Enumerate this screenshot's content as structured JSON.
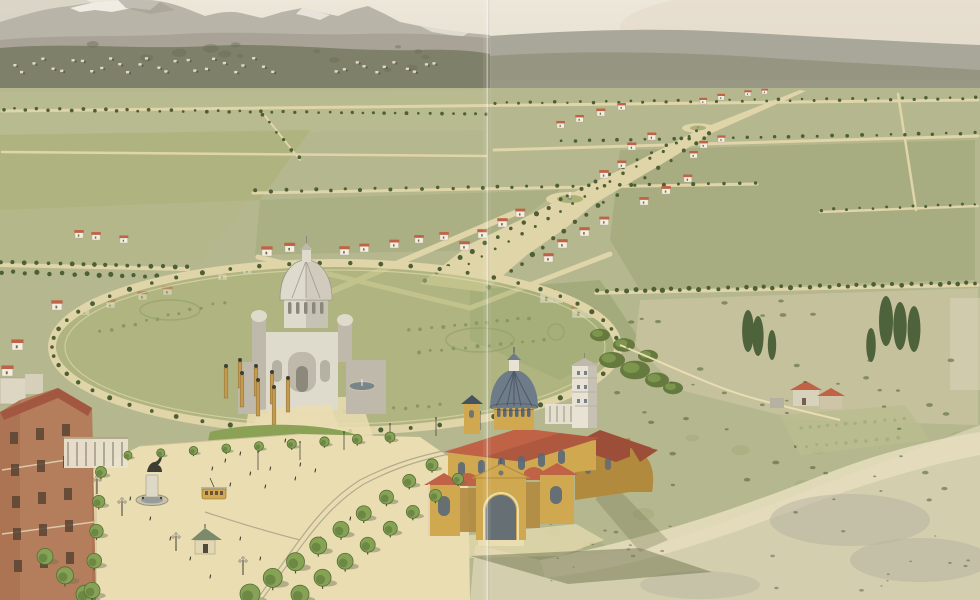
{
  "meta": {
    "description": "Panoramic bird's-eye watercolor view of a planned city extension: tree-lined avenues across an olive plain, a grand diagonal boulevard with roundabouts and scattered red-roofed villas, an elliptical garden plaza holding a white domed votive monument with ochre gateway pylons, an ochre parish church with a slate ribbed dome and white campanile in the foreground, a brick institutional building at lower left, scrubland with a small farmhouse at right, and snow-capped mountains above a distant hillside town."
  },
  "palette": {
    "sky_top": "#ece7d9",
    "sky_bottom": "#ddd7c4",
    "blush": "#e3d4c6",
    "mountain": "#b8b5a8",
    "mountain_shadow": "#a39f91",
    "snow": "#f2efe6",
    "mid_band": "#a6a194",
    "ridge": "#a9a79a",
    "ridge_dark": "#939480",
    "hill_dark": "#7e8069",
    "hill_text": "#6a6d55",
    "town_light": "#ded9c8",
    "town_dark": "#5c5e4c",
    "plain": "#b5b78e",
    "road": "#e0d4a9",
    "road_light": "#ead db2",
    "tree_dark": "#4d5f35",
    "tree_mid": "#66793f",
    "tree_fg": "#86a355",
    "tree_fg_dark": "#546e35",
    "trunk": "#5c4a30",
    "shadow_olive": "#6f7350",
    "garden": "#aab277",
    "bed": "#8fa065",
    "basilica_light": "#dedbcd",
    "basilica_mid": "#beb9aa",
    "basilica_shadow": "#96948a",
    "water": "#6f7d85",
    "pylon": "#c49a4e",
    "church_wall": "#d0a84f",
    "church_wall_dark": "#b28a3e",
    "church_roof": "#bf6246",
    "church_roof_dark": "#9c4e38",
    "dome": "#6e7b88",
    "dome_dark": "#45525f",
    "tower_white": "#e8e2d4",
    "brick": "#ad7454",
    "brick_dark": "#8f5a40",
    "brick_roof": "#a25741",
    "window_dark": "#5a4434",
    "slate": "#5a6878",
    "scrub": "#d3cead",
    "scrub_light": "#e4ddbd",
    "scrub_grey": "#b5b2a1",
    "tram": "#d2a850",
    "dark": "#3e3e34",
    "white": "#f2eee0"
  },
  "scene": {
    "sky": "Pale warm sky",
    "mountains": "Snow-capped mountains",
    "ridge": "Smooth grey-green ridge",
    "hills": "Dark wooded foothills",
    "town": "Distant hillside town",
    "plain": "Olive plain with avenues",
    "roads": "Tree-lined avenues",
    "boulevard": "Grand diagonal boulevard with roundabouts",
    "villas": "Scattered red-roofed villas",
    "plaza": "Elliptical garden plaza",
    "monument": "White domed votive monument",
    "pylons": "Ochre gateway pylons and strollers",
    "park": "Sloping park with winding paths",
    "avenue": "Foreground tree-lined avenue",
    "statue": "Equestrian statue with fountain basin",
    "kiosk": "Garden kiosk",
    "tram": "Yellow tramcar",
    "building": "Brick institutional building",
    "church": "Ochre parish church with slate dome",
    "scrub": "Scrubland, farmhouse and poplars",
    "fold": "Vertical fold crease in the print"
  },
  "gen": {
    "treeRows": [
      [
        4,
        109,
        486,
        114,
        44,
        1.6,
        "dark"
      ],
      [
        494,
        103,
        976,
        98,
        40,
        1.5,
        "dark"
      ],
      [
        560,
        141,
        976,
        133,
        30,
        1.6,
        "dark"
      ],
      [
        255,
        191,
        755,
        183,
        34,
        1.8,
        "dark"
      ],
      [
        598,
        291,
        976,
        283,
        42,
        2.2,
        "dark"
      ],
      [
        2,
        262,
        186,
        267,
        17,
        2.2,
        "dark"
      ],
      [
        2,
        272,
        182,
        277,
        16,
        2.2,
        "dark"
      ],
      [
        424,
        280,
        560,
        200,
        12,
        2.2,
        "dark"
      ],
      [
        566,
        196,
        696,
        131,
        10,
        1.8,
        "dark"
      ],
      [
        488,
        288,
        598,
        206,
        11,
        2.2,
        "dark"
      ],
      [
        604,
        203,
        710,
        134,
        9,
        1.8,
        "dark"
      ],
      [
        470,
        264,
        688,
        136,
        18,
        1.5,
        "dark"
      ],
      [
        822,
        210,
        976,
        204,
        13,
        1.4,
        "dark"
      ],
      [
        262,
        114,
        300,
        158,
        6,
        1.6,
        "dark"
      ],
      [
        800,
        428,
        903,
        419,
        12,
        1.7,
        "mid"
      ],
      [
        795,
        447,
        898,
        438,
        11,
        1.7,
        "mid"
      ],
      [
        100,
        332,
        225,
        302,
        12,
        1.6,
        "mid"
      ],
      [
        410,
        330,
        530,
        318,
        12,
        1.7,
        "mid"
      ],
      [
        420,
        352,
        545,
        340,
        12,
        1.7,
        "mid"
      ],
      [
        310,
        415,
        440,
        405,
        12,
        1.8,
        "mid"
      ]
    ],
    "ring": {
      "cx": 335,
      "cy": 347,
      "rx": 283,
      "ry": 84,
      "n": 58,
      "r": 2.2
    },
    "bigTreeRows": [
      [
        45,
        558,
        85,
        596,
        3,
        8,
        9
      ],
      [
        101,
        473,
        92,
        592,
        5,
        5.5,
        8
      ],
      [
        128,
        456,
        390,
        438,
        9,
        4,
        5
      ],
      [
        432,
        466,
        250,
        596,
        9,
        6,
        10
      ],
      [
        458,
        480,
        300,
        596,
        8,
        5.5,
        9
      ]
    ],
    "parkClumps": [
      [
        238,
        470,
        16
      ],
      [
        262,
        498,
        18
      ],
      [
        290,
        478,
        15
      ],
      [
        315,
        500,
        17
      ],
      [
        340,
        484,
        14
      ],
      [
        365,
        508,
        15
      ],
      [
        388,
        490,
        13
      ],
      [
        300,
        535,
        16
      ],
      [
        335,
        540,
        14
      ],
      [
        262,
        540,
        15
      ],
      [
        410,
        510,
        12
      ],
      [
        428,
        492,
        11
      ],
      [
        370,
        545,
        12
      ],
      [
        225,
        515,
        13
      ],
      [
        250,
        452,
        12
      ],
      [
        300,
        452,
        12
      ],
      [
        348,
        458,
        12
      ],
      [
        398,
        468,
        11
      ]
    ],
    "greenClumps": [
      [
        612,
        360,
        13
      ],
      [
        635,
        370,
        15
      ],
      [
        657,
        380,
        12
      ],
      [
        673,
        388,
        10
      ],
      [
        600,
        335,
        10
      ],
      [
        624,
        345,
        11
      ],
      [
        648,
        356,
        10
      ]
    ],
    "villas": [
      [
        557,
        128,
        0.8
      ],
      [
        576,
        122,
        0.8
      ],
      [
        597,
        116,
        0.85
      ],
      [
        618,
        110,
        0.8
      ],
      [
        700,
        104,
        0.7
      ],
      [
        718,
        100,
        0.7
      ],
      [
        745,
        96,
        0.65
      ],
      [
        762,
        94,
        0.6
      ],
      [
        628,
        150,
        0.85
      ],
      [
        648,
        140,
        0.85
      ],
      [
        700,
        148,
        0.8
      ],
      [
        718,
        142,
        0.75
      ],
      [
        690,
        158,
        0.8
      ],
      [
        640,
        205,
        0.9
      ],
      [
        662,
        194,
        0.9
      ],
      [
        684,
        182,
        0.85
      ],
      [
        600,
        178,
        0.9
      ],
      [
        618,
        168,
        0.85
      ],
      [
        478,
        238,
        1
      ],
      [
        498,
        227,
        1
      ],
      [
        516,
        217,
        0.95
      ],
      [
        460,
        250,
        1
      ],
      [
        558,
        248,
        1
      ],
      [
        580,
        236,
        1
      ],
      [
        600,
        225,
        0.95
      ],
      [
        544,
        262,
        1
      ],
      [
        262,
        256,
        1.1
      ],
      [
        285,
        252,
        1.05
      ],
      [
        340,
        255,
        1
      ],
      [
        360,
        252,
        0.95
      ],
      [
        390,
        248,
        0.95
      ],
      [
        415,
        243,
        0.9
      ],
      [
        440,
        240,
        0.9
      ],
      [
        12,
        350,
        1.2
      ],
      [
        2,
        376,
        1.2
      ],
      [
        52,
        310,
        1.1
      ],
      [
        80,
        315,
        1.05
      ],
      [
        106,
        308,
        1
      ],
      [
        138,
        300,
        1
      ],
      [
        163,
        295,
        1
      ],
      [
        218,
        280,
        1
      ],
      [
        243,
        274,
        0.95
      ],
      [
        92,
        240,
        0.9
      ],
      [
        120,
        243,
        0.85
      ],
      [
        75,
        238,
        0.9
      ]
    ],
    "mansions": [
      [
        540,
        303
      ],
      [
        572,
        318
      ]
    ],
    "townRows": [
      {
        "x0": 10,
        "y0": 64,
        "dx": 9.6,
        "n": 28,
        "amp": 7
      },
      {
        "x0": 332,
        "y0": 66,
        "dx": 10,
        "n": 11,
        "amp": 5
      }
    ],
    "mottle": [
      {
        "x": 5,
        "y": 118,
        "w": 480,
        "h": 135,
        "n": 42,
        "r0": 2,
        "r1": 7,
        "c": "hill-text",
        "o": 0.35
      },
      {
        "x": 610,
        "y": 150,
        "w": 360,
        "h": 128,
        "n": 26,
        "r0": 3,
        "r1": 9,
        "c": "tree-mid",
        "o": 0.3
      },
      {
        "x": 605,
        "y": 300,
        "w": 365,
        "h": 215,
        "n": 48,
        "r0": 1.5,
        "r1": 3.5,
        "c": "tree-dark",
        "o": 0.55
      },
      {
        "x": 480,
        "y": 430,
        "w": 490,
        "h": 162,
        "n": 30,
        "r0": 4,
        "r1": 12,
        "c": "bed",
        "o": 0.25
      },
      {
        "x": 500,
        "y": 520,
        "w": 470,
        "h": 72,
        "n": 26,
        "r0": 1,
        "r1": 2.5,
        "c": "dark",
        "o": 0.4
      },
      {
        "x": 20,
        "y": 42,
        "w": 450,
        "h": 28,
        "n": 14,
        "r0": 3,
        "r1": 8,
        "c": "hill-text",
        "o": 0.45
      }
    ],
    "figures": [
      [
        212,
        470
      ],
      [
        225,
        462
      ],
      [
        240,
        455
      ],
      [
        255,
        448
      ],
      [
        270,
        470
      ],
      [
        285,
        442
      ],
      [
        300,
        466
      ],
      [
        250,
        475
      ],
      [
        230,
        486
      ],
      [
        265,
        488
      ],
      [
        295,
        480
      ],
      [
        315,
        472
      ],
      [
        150,
        520
      ],
      [
        170,
        540
      ],
      [
        190,
        560
      ],
      [
        210,
        578
      ],
      [
        130,
        500
      ],
      [
        240,
        540
      ],
      [
        260,
        560
      ],
      [
        280,
        578
      ],
      [
        320,
        540
      ],
      [
        350,
        520
      ],
      [
        380,
        500
      ],
      [
        410,
        480
      ]
    ],
    "lamps": [
      [
        122,
        516
      ],
      [
        176,
        551
      ],
      [
        243,
        575
      ],
      [
        97,
        494
      ]
    ],
    "poles": [
      [
        258,
        470
      ],
      [
        300,
        460
      ],
      [
        344,
        450
      ],
      [
        390,
        442
      ],
      [
        436,
        436
      ],
      [
        480,
        430
      ]
    ],
    "poplars": [
      [
        748,
        352,
        42
      ],
      [
        758,
        356,
        40
      ],
      [
        886,
        346,
        50
      ],
      [
        900,
        350,
        48
      ],
      [
        914,
        352,
        46
      ],
      [
        871,
        362,
        34
      ],
      [
        772,
        360,
        30
      ]
    ],
    "pylons": [
      [
        240,
        388,
        26
      ],
      [
        256,
        396,
        28
      ],
      [
        272,
        404,
        30
      ],
      [
        288,
        412,
        32
      ],
      [
        226,
        398,
        30
      ],
      [
        242,
        407,
        32
      ],
      [
        258,
        416,
        34
      ],
      [
        274,
        425,
        36
      ]
    ]
  }
}
